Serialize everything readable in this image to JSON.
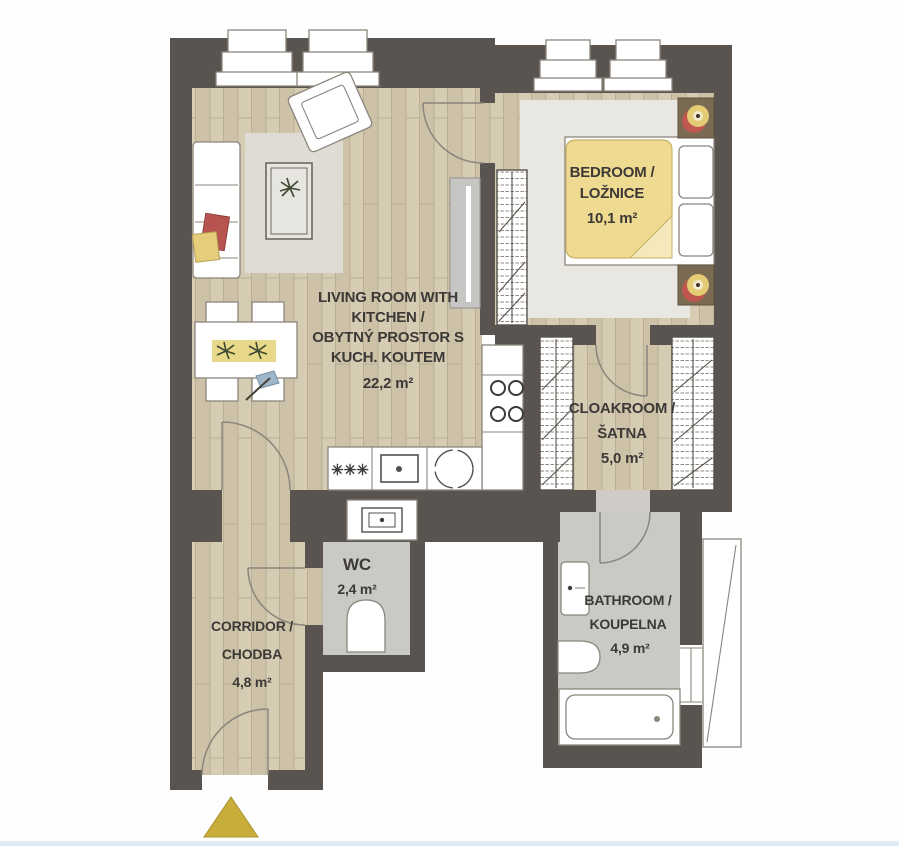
{
  "plan": {
    "colors": {
      "wall": "#59544f",
      "wood_light": "#d6ccb4",
      "wood_dark": "#c8bda2",
      "wood_line": "#b3a78c",
      "tile": "#c9c9c6",
      "rug": "#e9e7e2",
      "rug_living": "#dedcd5",
      "line": "#8b857c",
      "text": "#3c3936",
      "duvet": "#eeda90",
      "duvet_fold": "#f5e9bc",
      "runner": "#e8d88a",
      "pillow_red": "#b85450",
      "pillow_yellow": "#e6cd7c",
      "lamp_red": "#c0574f",
      "lamp_yellow": "#e3cc74",
      "furniture_wood": "#7a6a52",
      "marker_gold": "#c9ad3a",
      "plant_green": "#3d4a30",
      "blue_item": "#9fb6c8",
      "scan_edge": "#dfeaf2"
    },
    "rooms": {
      "living": {
        "line1": "LIVING ROOM WITH",
        "line2": "KITCHEN /",
        "line3": "OBYTNÝ PROSTOR S",
        "line4": "KUCH. KOUTEM",
        "area": "22,2 m²"
      },
      "bedroom": {
        "line1": "BEDROOM /",
        "line2": "LOŽNICE",
        "area": "10,1 m²"
      },
      "cloakroom": {
        "line1": "CLOAKROOM /",
        "line2": "ŠATNA",
        "area": "5,0 m²"
      },
      "wc": {
        "line1": "WC",
        "area": "2,4 m²"
      },
      "bathroom": {
        "line1": "BATHROOM /",
        "line2": "KOUPELNA",
        "area": "4,9 m²"
      },
      "corridor": {
        "line1": "CORRIDOR /",
        "line2": "CHODBA",
        "area": "4,8 m²"
      }
    }
  }
}
